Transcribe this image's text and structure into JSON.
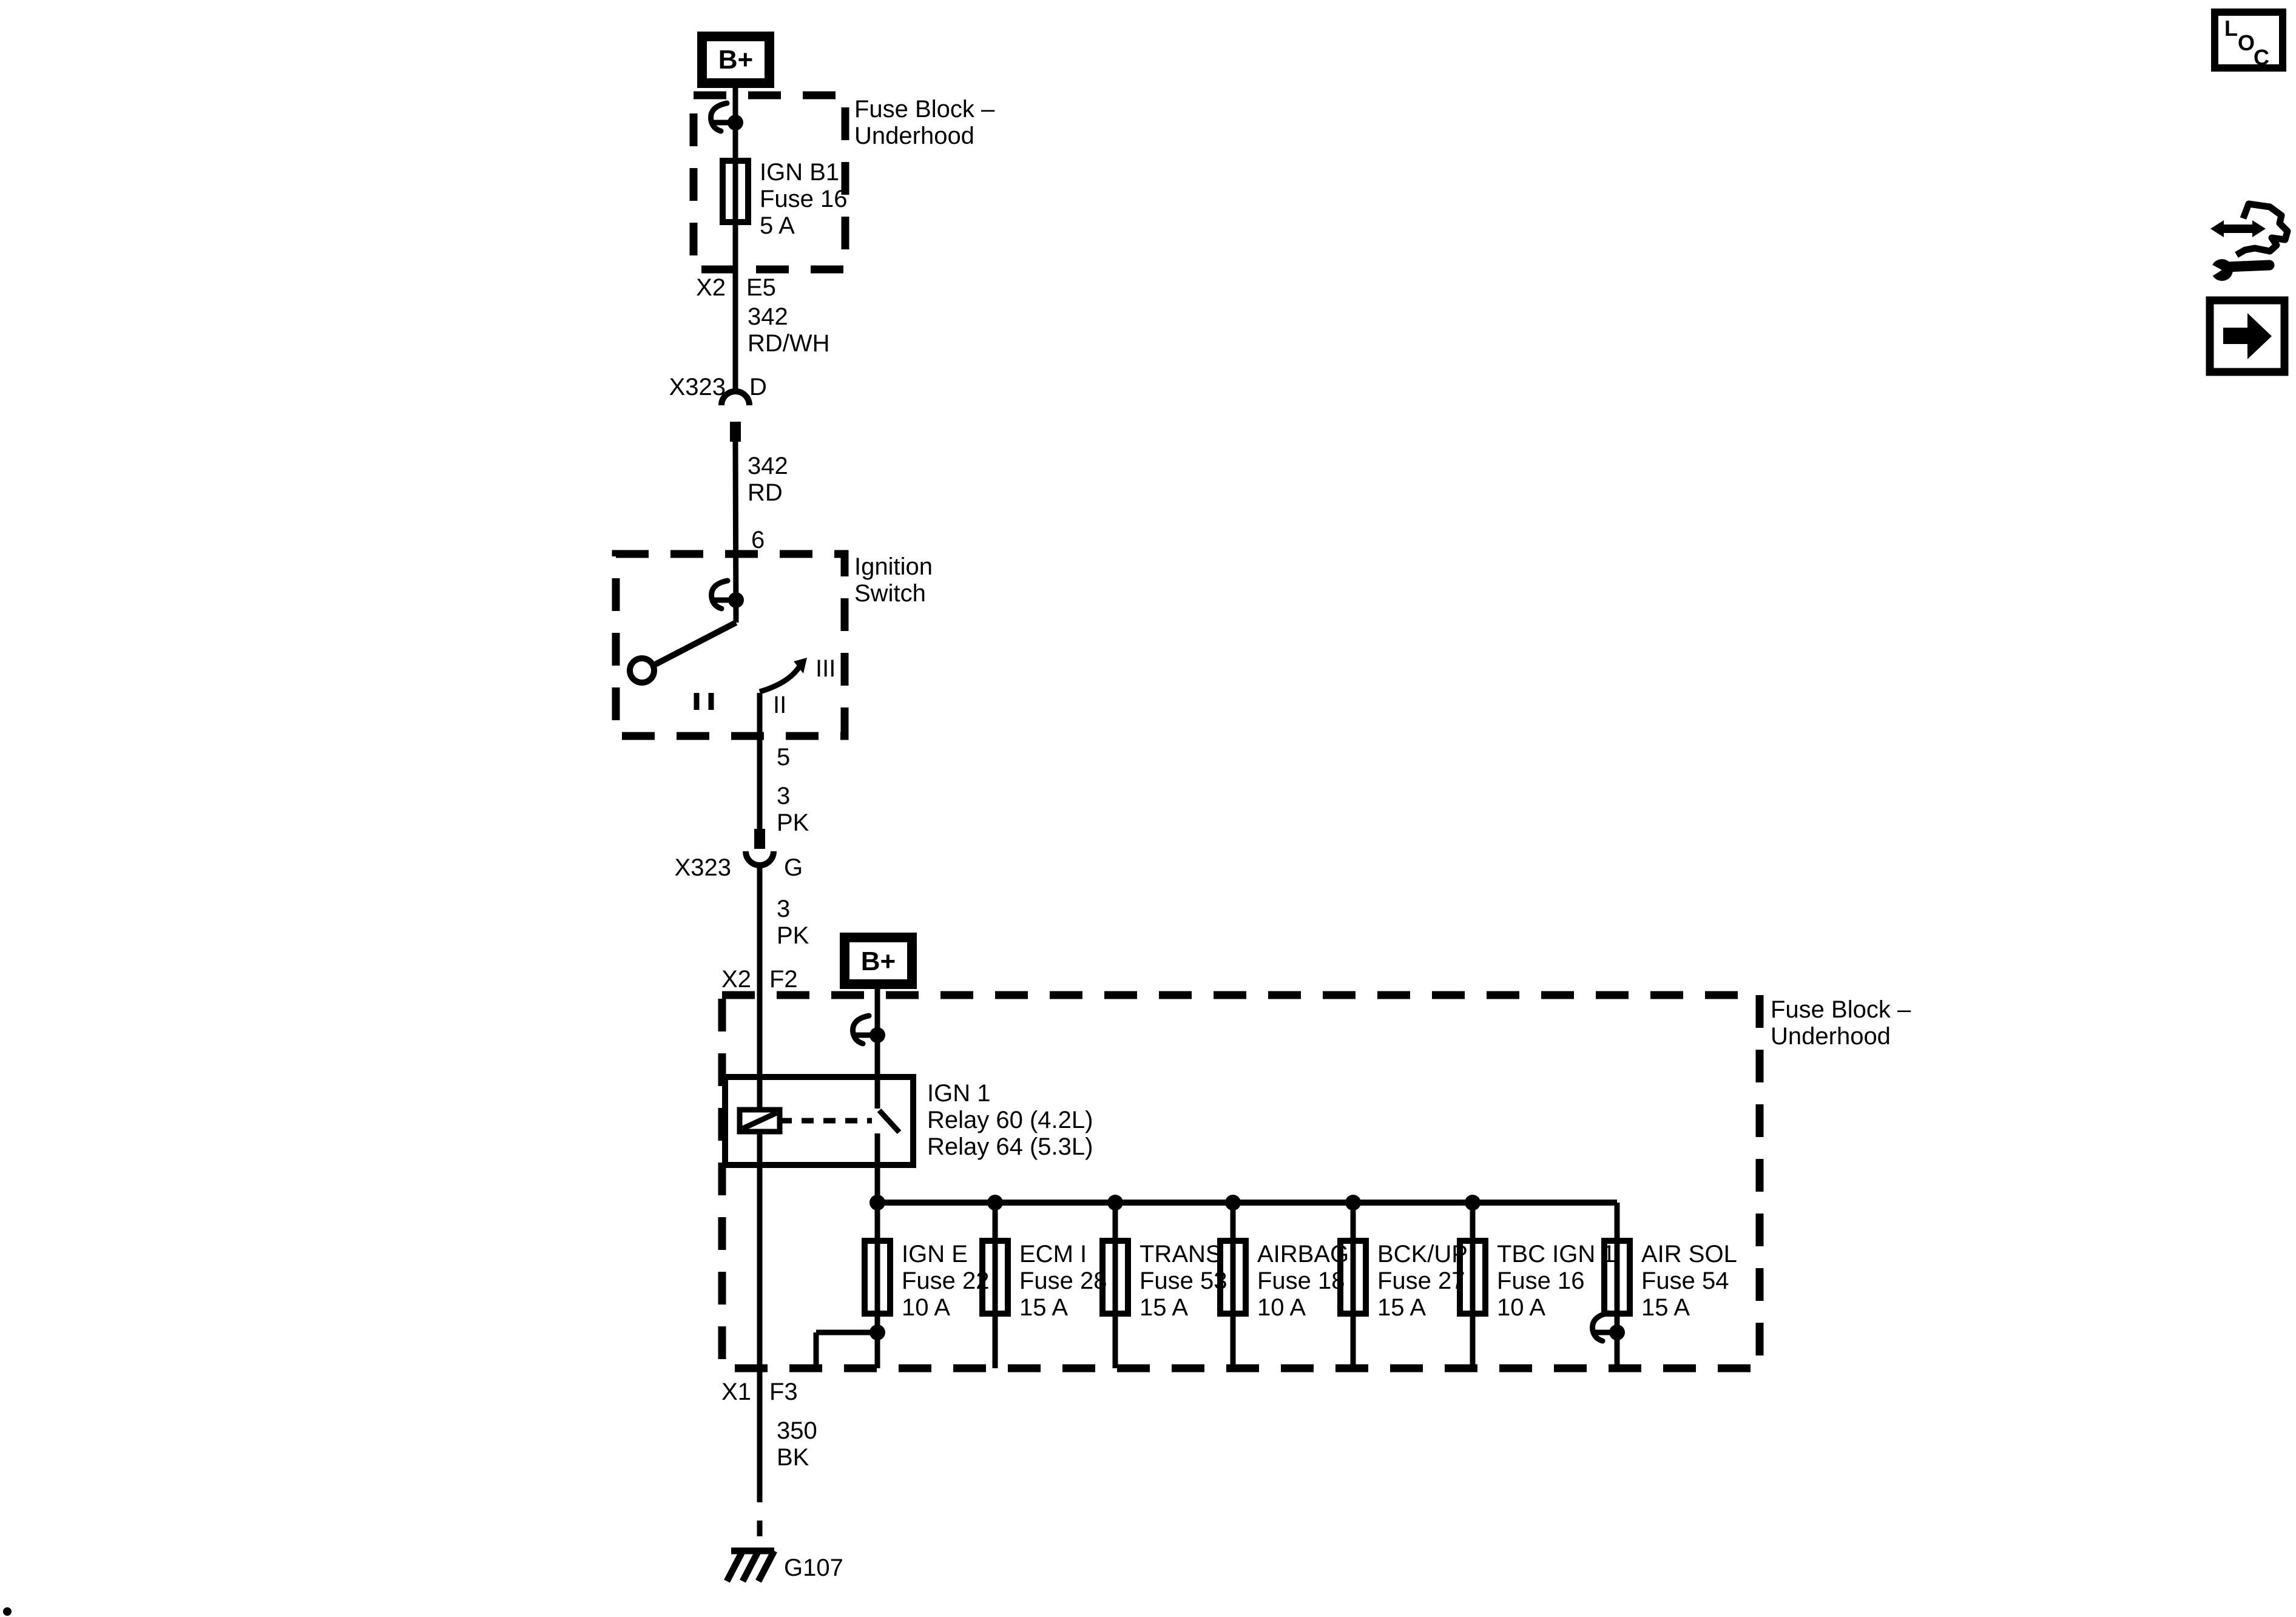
{
  "terminals": {
    "top": "B+",
    "mid": "B+"
  },
  "top_fuse_block": {
    "label_line1": "Fuse Block –",
    "label_line2": "Underhood",
    "fuse_name": "IGN B1",
    "fuse_id": "Fuse 16",
    "fuse_amps": "5 A",
    "out_connector": "X2",
    "out_pin": "E5"
  },
  "wire_342_rdwh": {
    "circuit": "342",
    "color": "RD/WH"
  },
  "connector_d": {
    "name": "X323",
    "pin": "D"
  },
  "wire_342_rd": {
    "circuit": "342",
    "color": "RD"
  },
  "ignition_switch": {
    "pin_in": "6",
    "label_line1": "Ignition",
    "label_line2": "Switch",
    "pos_2": "II",
    "pos_3": "III",
    "pin_out": "5"
  },
  "wire_3_pk_upper": {
    "circuit": "3",
    "color": "PK"
  },
  "connector_g": {
    "name": "X323",
    "pin": "G"
  },
  "wire_3_pk_lower": {
    "circuit": "3",
    "color": "PK"
  },
  "main_fuse_block": {
    "in_connector": "X2",
    "in_pin": "F2",
    "label_line1": "Fuse Block –",
    "label_line2": "Underhood",
    "relay_line1": "IGN 1",
    "relay_line2": "Relay 60 (4.2L)",
    "relay_line3": "Relay 64 (5.3L)",
    "fuses": [
      {
        "name": "IGN E",
        "id": "Fuse 22",
        "amps": "10 A"
      },
      {
        "name": "ECM I",
        "id": "Fuse 28",
        "amps": "15 A"
      },
      {
        "name": "TRANS",
        "id": "Fuse 53",
        "amps": "15 A"
      },
      {
        "name": "AIRBAG",
        "id": "Fuse 18",
        "amps": "10 A"
      },
      {
        "name": "BCK/UP",
        "id": "Fuse 27",
        "amps": "15 A"
      },
      {
        "name": "TBC IGN 1",
        "id": "Fuse 16",
        "amps": "10 A"
      },
      {
        "name": "AIR SOL",
        "id": "Fuse 54",
        "amps": "15 A"
      }
    ],
    "out_connector": "X1",
    "out_pin": "F3"
  },
  "wire_350_bk": {
    "circuit": "350",
    "color": "BK"
  },
  "ground": {
    "label": "G107"
  },
  "corner_icons": {
    "loc_l": "L",
    "loc_o": "O",
    "loc_c": "C"
  },
  "colors": {
    "ink": "#000000",
    "paper": "#ffffff"
  }
}
